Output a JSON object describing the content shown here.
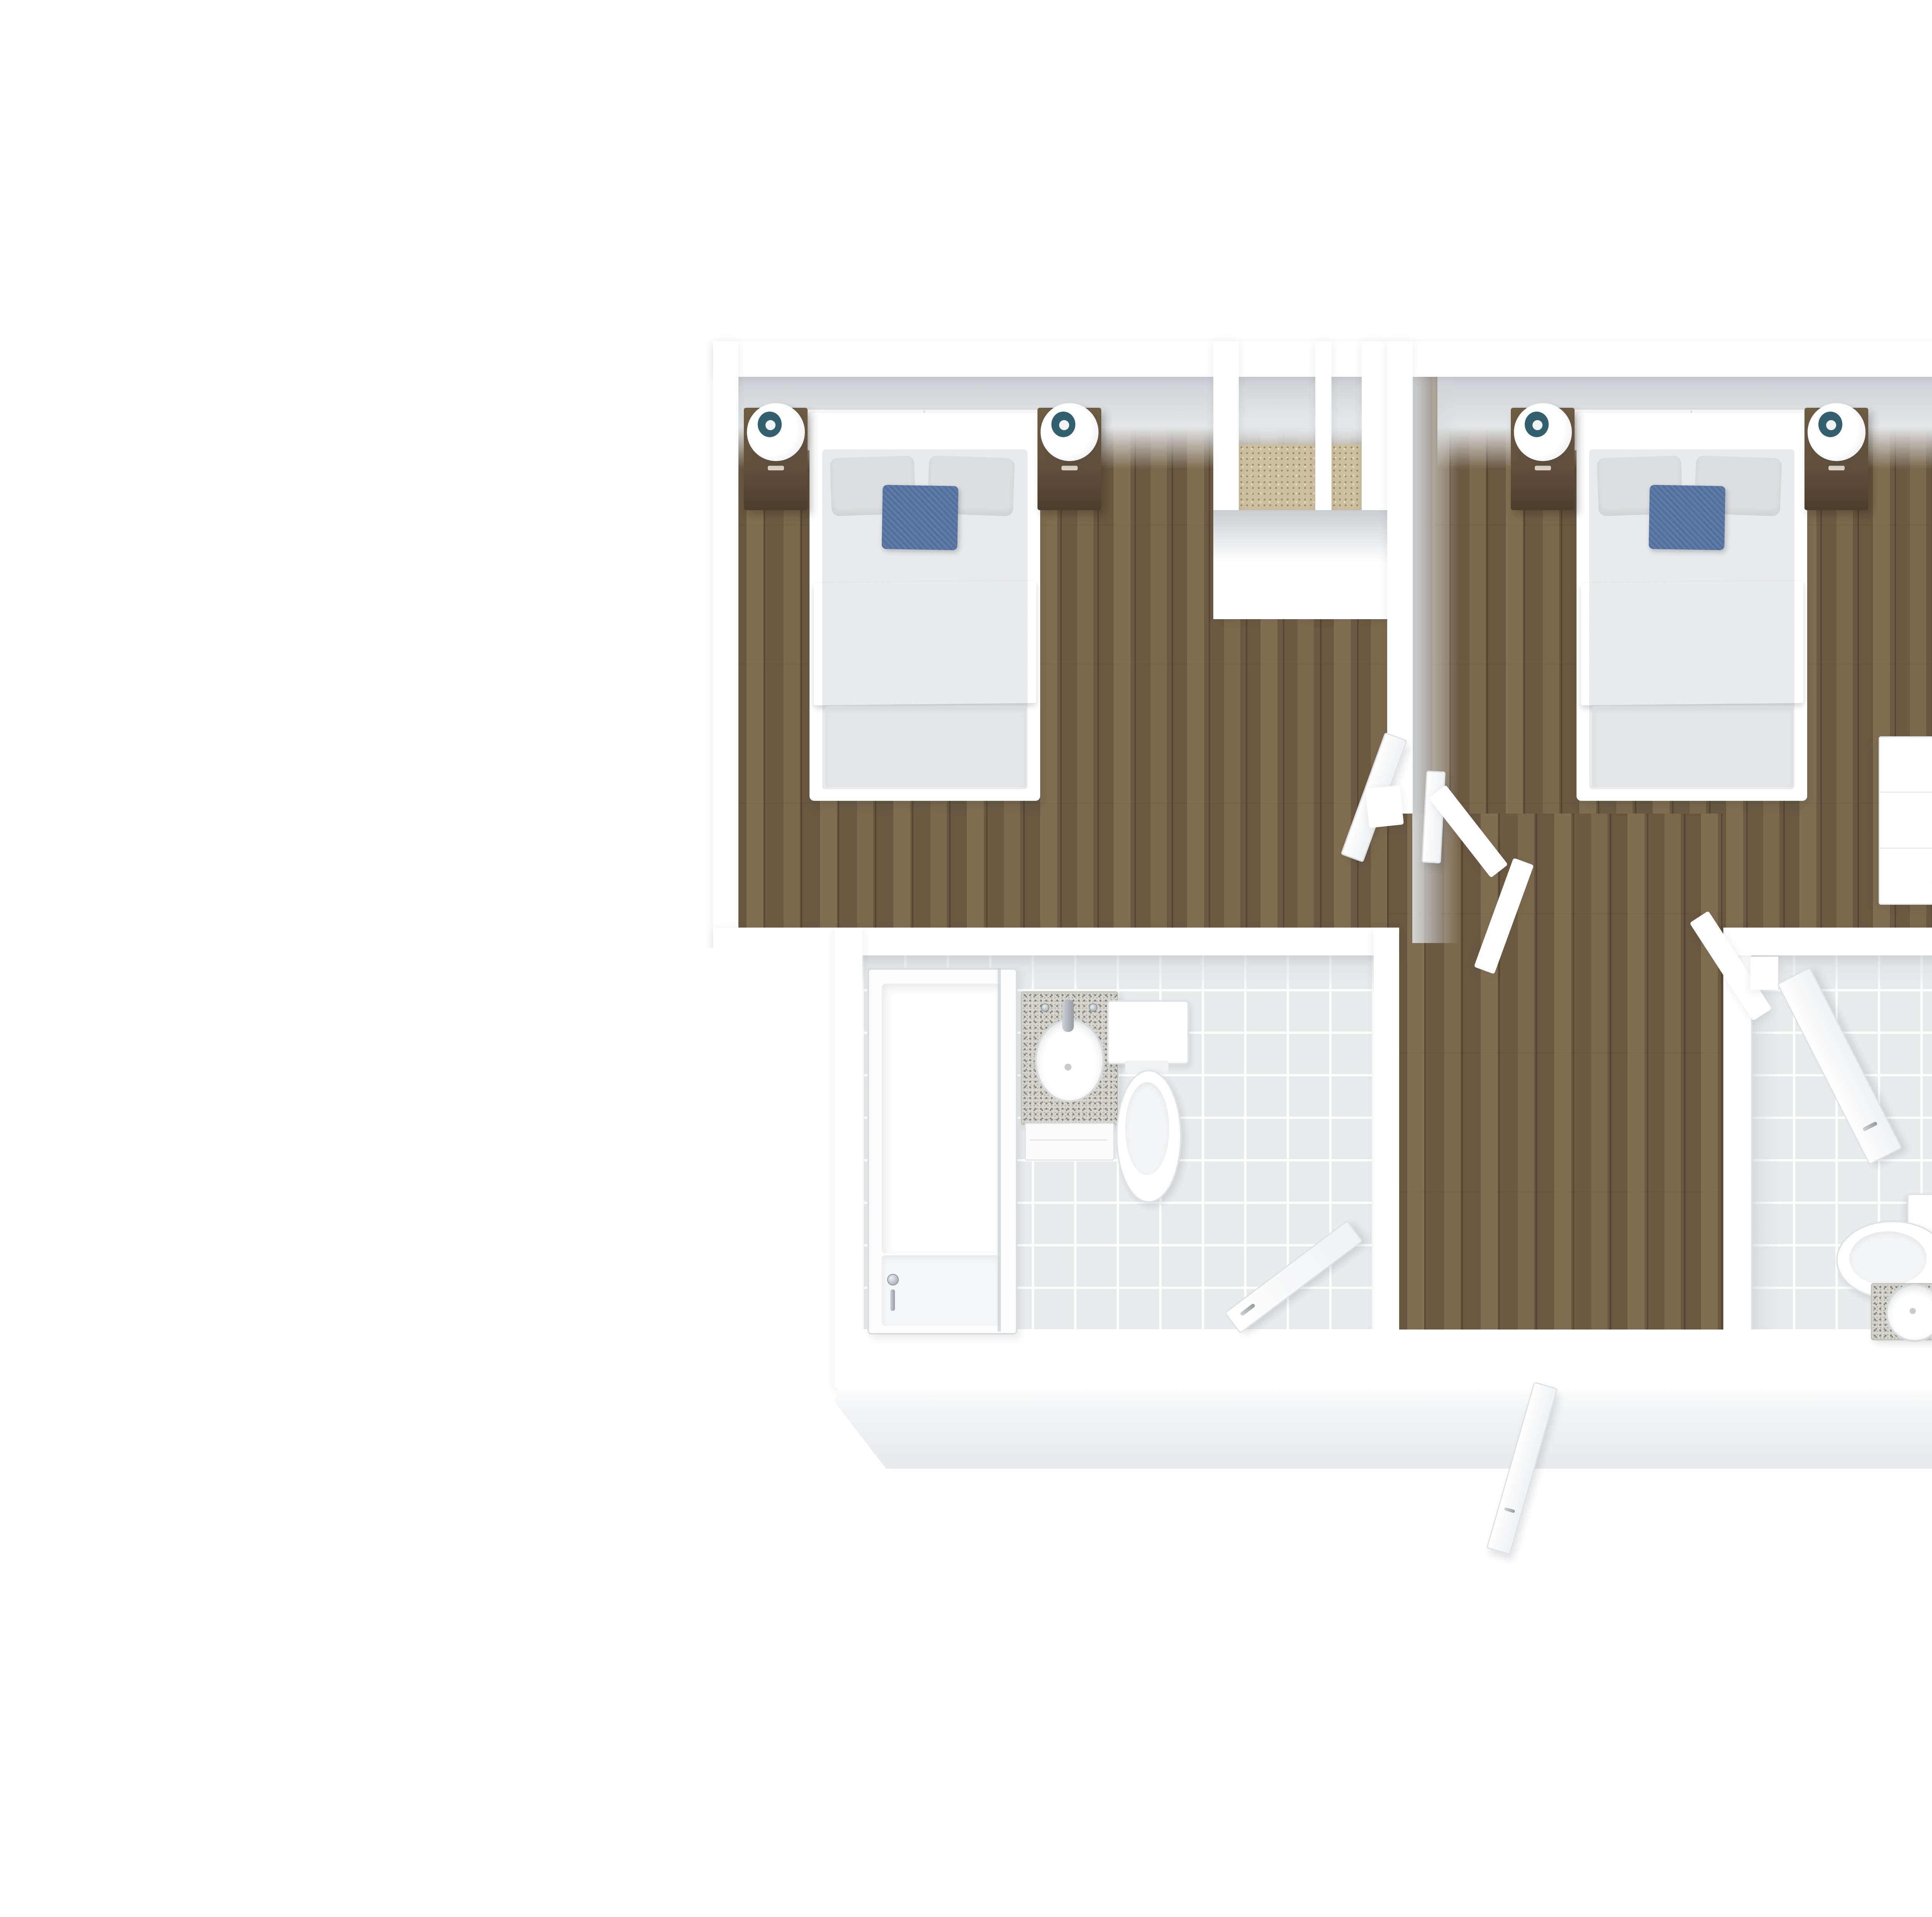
{
  "floor_plan": {
    "view": "top-down-3d-render",
    "rooms": [
      {
        "name": "bedroom-left",
        "floor": "hardwood",
        "furniture": [
          "double-bed",
          "grey-pillows",
          "blue-accent-pillow",
          "blue-throw-blanket",
          "nightstand-left",
          "table-lamp-left",
          "nightstand-right",
          "table-lamp-right"
        ]
      },
      {
        "name": "closet-nook",
        "floor": "carpet"
      },
      {
        "name": "closet-recess",
        "floor": "carpet"
      },
      {
        "name": "bedroom-right",
        "floor": "hardwood",
        "furniture": [
          "double-bed",
          "grey-pillows",
          "blue-accent-pillow",
          "blue-throw-blanket",
          "nightstand-left",
          "table-lamp-left",
          "nightstand-right",
          "table-lamp-right",
          "white-dresser"
        ]
      },
      {
        "name": "bathroom-left",
        "floor": "tile",
        "fixtures": [
          "bathtub-with-glass-screen",
          "granite-vanity-with-oval-sink",
          "toilet",
          "open-door"
        ]
      },
      {
        "name": "hallway",
        "floor": "hardwood",
        "fixtures": [
          "open-interior-doors",
          "angled-partition-walls",
          "open-entry-door"
        ]
      },
      {
        "name": "bathroom-right",
        "floor": "tile",
        "fixtures": [
          "open-door",
          "toilet",
          "granite-vanity-with-round-sink"
        ]
      }
    ]
  },
  "colors": {
    "page_bg": "#ffffff",
    "wall_white": "#ffffff",
    "wall_face_grey": "#d3d7da",
    "wood_base": "#7b684d",
    "tile_base": "#e8eced",
    "tile_grout": "#ffffff",
    "carpet_beige": "#cdc0a0",
    "mattress_grey": "#e9eaeb",
    "pillow_grey": "#dcdedf",
    "accent_blue": "#54719e",
    "throw_blue": "#50688f",
    "nightstand_brown": "#63513c",
    "nightstand_brown_dark": "#4c3d2c",
    "lamp_teal": "#33606e",
    "granite_grey": "#d6d6cf",
    "granite_speck": "#85857a",
    "fixture_border": "#dfe3e5",
    "chrome": "#a7aeb3"
  }
}
